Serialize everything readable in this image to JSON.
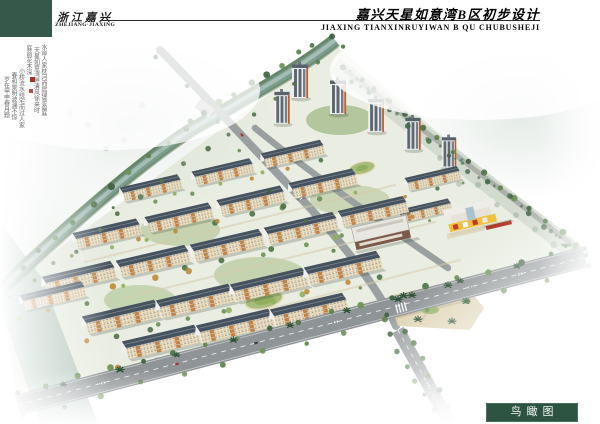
{
  "header": {
    "location_cn": "浙江嘉兴",
    "location_en": "ZHEJIANG·JIAXING",
    "title_cn": "嘉兴天星如意湾B区初步设计",
    "title_en": "JIAXING TIANXINRUYIWAN B QU CHUBUSHEJI"
  },
  "annotation": {
    "calligraphy_columns": [
      "水岸人家枕河而居绿意盈庭",
      "天星如意湾畔清风徐来时",
      "庭前花木深",
      "小桥流水绕宅而过人家",
      "春和景明波澜不惊",
      "岁在甲申春月题"
    ],
    "seal_color": "#a83226"
  },
  "footer": {
    "view_label": "鸟瞰图"
  },
  "palette": {
    "header_green": "#36584a",
    "label_green": "#2d5343",
    "water": "#7d9c90",
    "road_gray": "#8f9496",
    "roof_slate": "#46525e",
    "facade_cream": "#e9dcbe",
    "accent_orange": "#bd7c40",
    "tree_green": "#4e7344",
    "kindergarten_yellow": "#f0c23c",
    "plaza_beige": "#dbcfae"
  }
}
